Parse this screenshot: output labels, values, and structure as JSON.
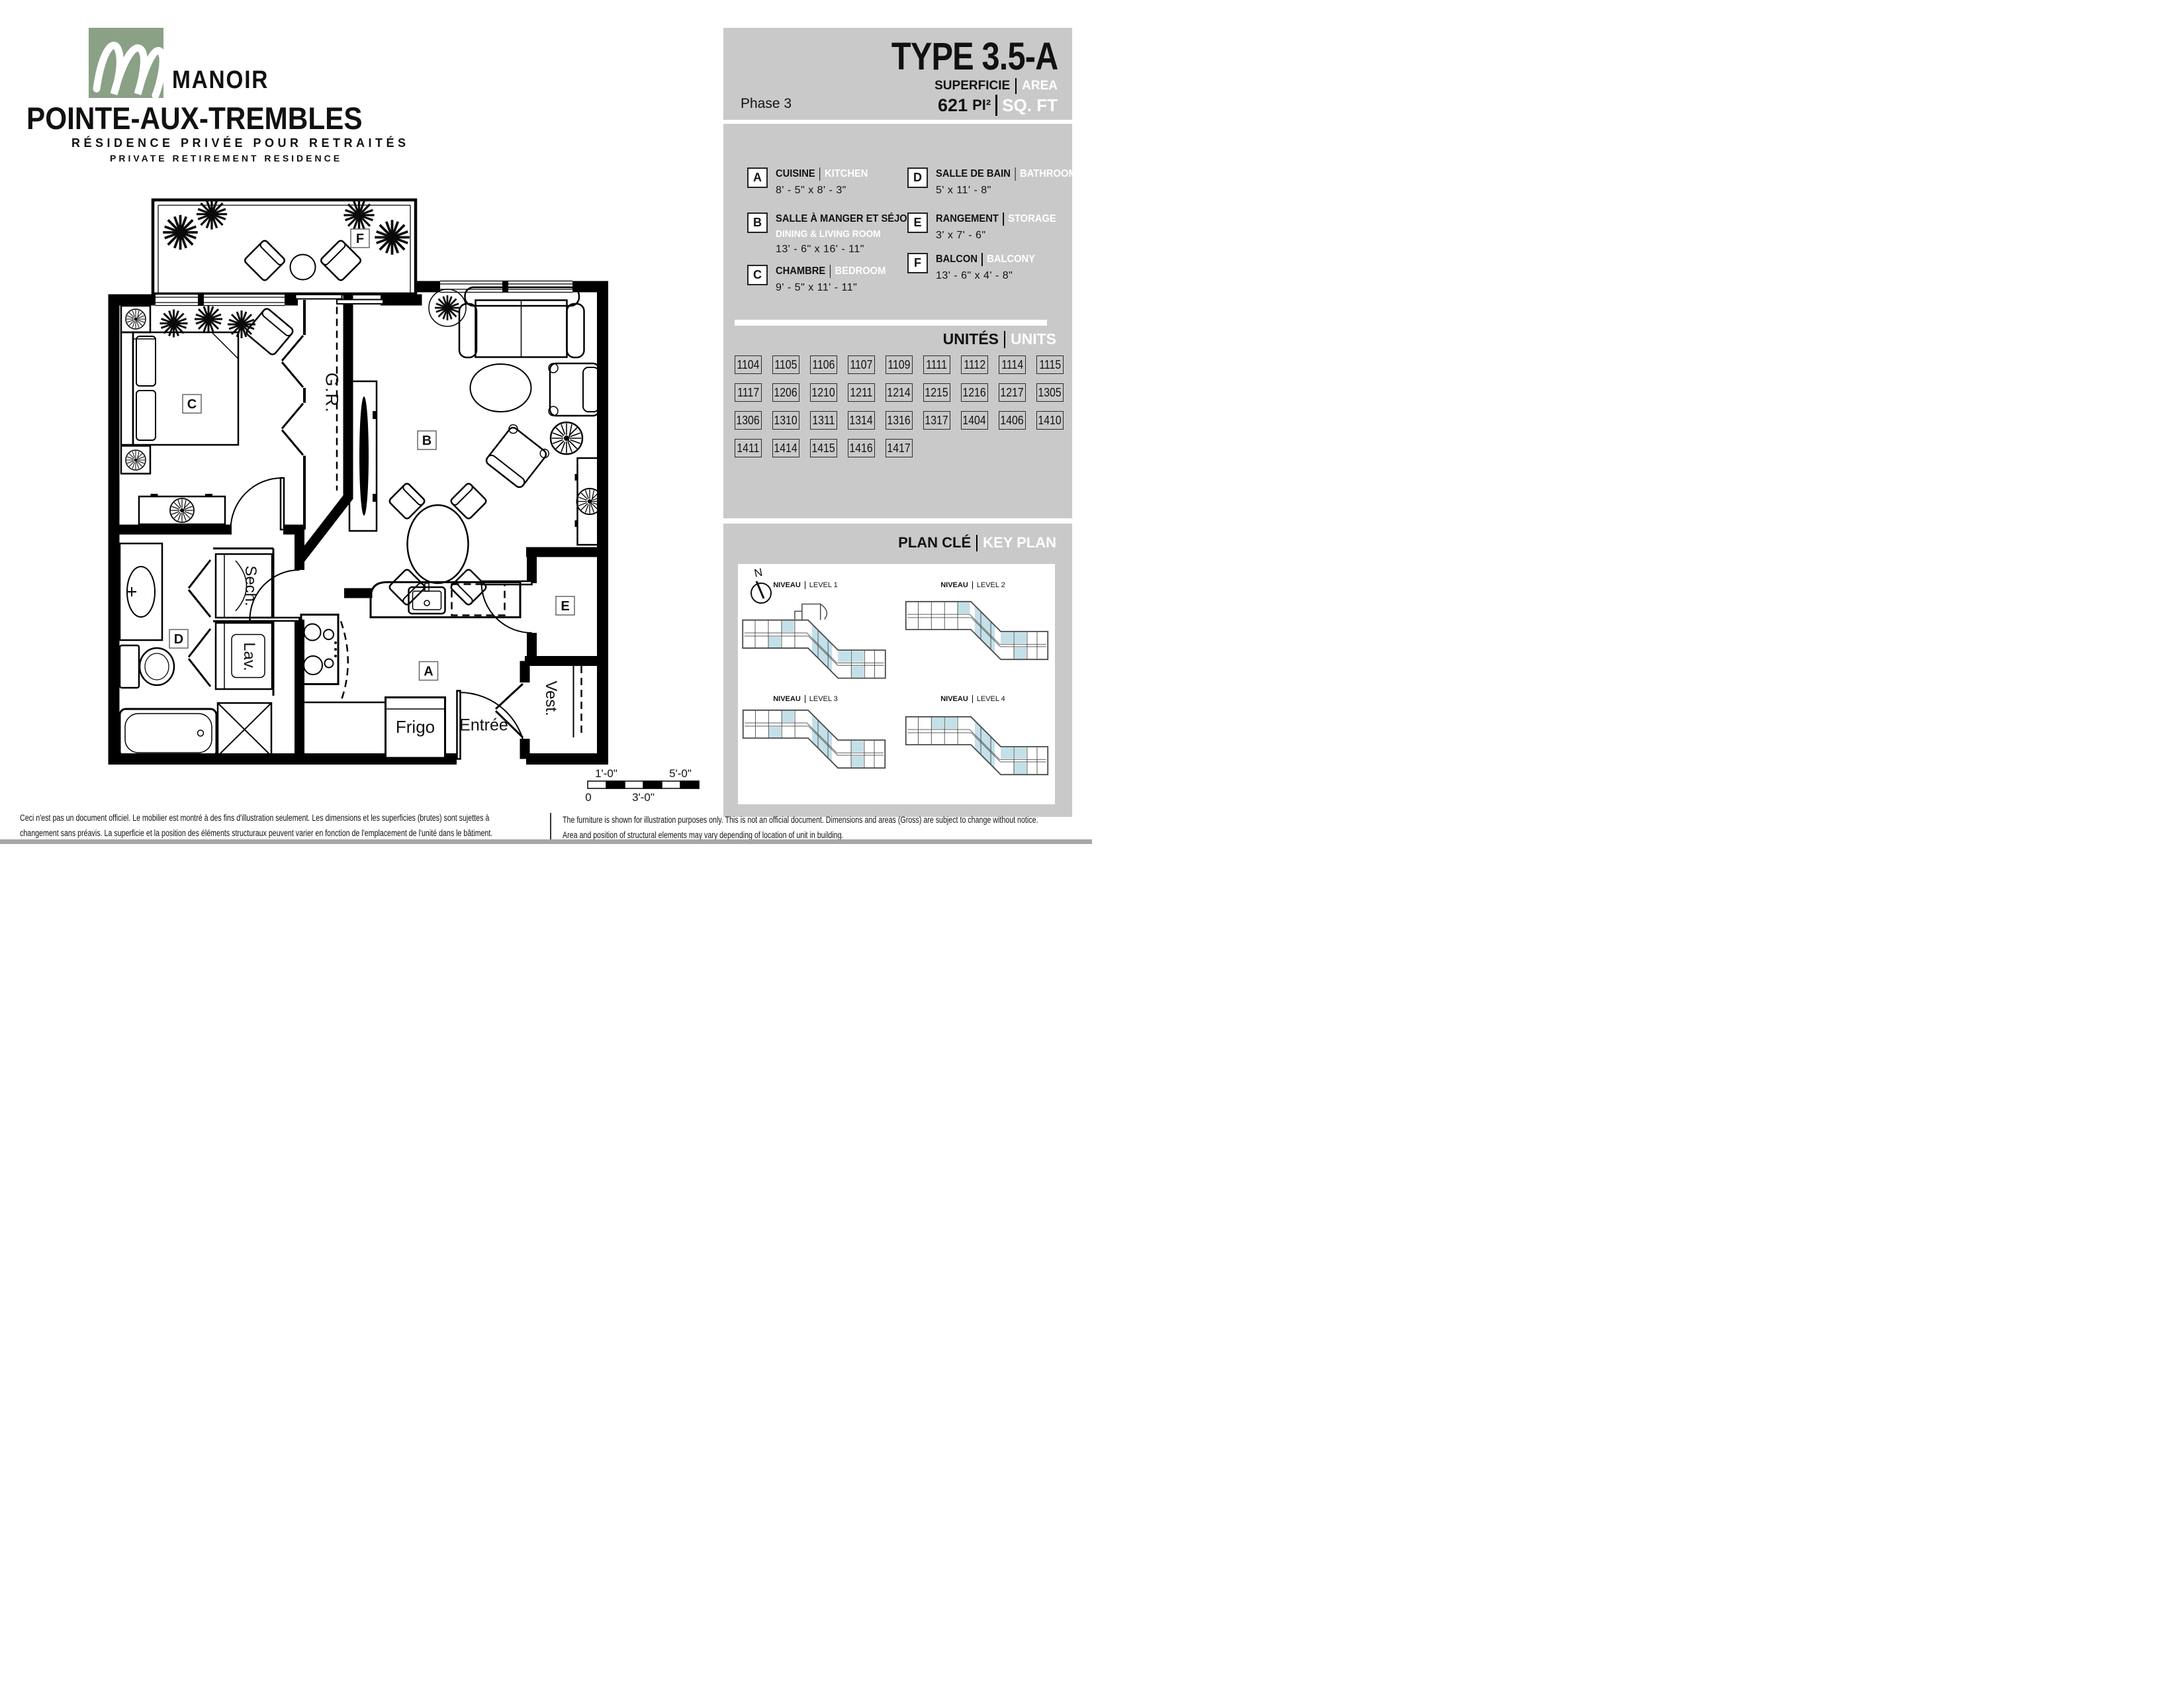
{
  "colors": {
    "panel_gray": "#c9c9c9",
    "logo_green": "#8aa186",
    "keyplan_highlight_blue": "#c3e0e9",
    "keyplan_outline": "#4a4a4a",
    "bottom_strip_gray": "#a6a6a6",
    "text_black": "#111111",
    "text_white": "#ffffff"
  },
  "logo": {
    "monogram": "M",
    "brand_line1": "MANOIR",
    "brand_line2": "POINTE-AUX-TREMBLES",
    "tagline_fr": "RÉSIDENCE PRIVÉE POUR RETRAITÉS",
    "tagline_en": "PRIVATE RETIREMENT RESIDENCE"
  },
  "header": {
    "type_title": "TYPE  3.5-A",
    "superficie_fr": "SUPERFICIE",
    "superficie_en": "AREA",
    "phase": "Phase 3",
    "area_value": "621",
    "area_unit_fr": "PI²",
    "area_unit_en": "SQ. FT"
  },
  "legend": {
    "items": [
      {
        "letter": "A",
        "fr": "CUISINE",
        "en": "KITCHEN",
        "en2": "",
        "dims": "8' - 5\" x 8' - 3\""
      },
      {
        "letter": "B",
        "fr": "SALLE À MANGER ET SÉJOUR",
        "en": "",
        "en2": "DINING & LIVING ROOM",
        "dims": "13' - 6\" x 16' - 11\""
      },
      {
        "letter": "C",
        "fr": "CHAMBRE",
        "en": "BEDROOM",
        "en2": "",
        "dims": "9' - 5\" x 11' - 11\""
      },
      {
        "letter": "D",
        "fr": "SALLE DE BAIN",
        "en": "BATHROOM",
        "en2": "",
        "dims": "5' x 11' - 8\""
      },
      {
        "letter": "E",
        "fr": "RANGEMENT",
        "en": "STORAGE",
        "en2": "",
        "dims": "3' x 7' - 6\""
      },
      {
        "letter": "F",
        "fr": "BALCON",
        "en": "BALCONY",
        "en2": "",
        "dims": "13' - 6\" x 4' - 8\""
      }
    ]
  },
  "units": {
    "title_fr": "UNITÉS",
    "title_en": "UNITS",
    "numbers": [
      "1104",
      "1105",
      "1106",
      "1107",
      "1109",
      "1111",
      "1112",
      "1114",
      "1115",
      "1117",
      "1206",
      "1210",
      "1211",
      "1214",
      "1215",
      "1216",
      "1217",
      "1305",
      "1306",
      "1310",
      "1311",
      "1314",
      "1316",
      "1317",
      "1404",
      "1406",
      "1410",
      "1411",
      "1414",
      "1415",
      "1416",
      "1417"
    ]
  },
  "keyplan": {
    "title_fr": "PLAN CLÉ",
    "title_en": "KEY PLAN",
    "north": "N",
    "levels": [
      {
        "fr": "NIVEAU",
        "en": "LEVEL 1"
      },
      {
        "fr": "NIVEAU",
        "en": "LEVEL 2"
      },
      {
        "fr": "NIVEAU",
        "en": "LEVEL 3"
      },
      {
        "fr": "NIVEAU",
        "en": "LEVEL 4"
      }
    ]
  },
  "plan": {
    "room_labels": {
      "a": "A",
      "b": "B",
      "c": "C",
      "d": "D",
      "e": "E",
      "f": "F"
    },
    "texts": {
      "gr": "G.R.",
      "sech": "Sech.",
      "lav": "Lav.",
      "frigo": "Frigo",
      "entree": "Entrée",
      "vest": "Vest."
    }
  },
  "scalebar": {
    "zero": "0",
    "one": "1'-0\"",
    "three": "3'-0\"",
    "five": "5'-0\""
  },
  "disclaimer": {
    "fr1": "Ceci n'est pas un document officiel.  Le mobilier est montré à des fins d'illustration seulement.  Les dimensions et les superficies (brutes) sont sujettes à",
    "fr2": "changement sans préavis. La superficie et la position des éléments structuraux peuvent varier en fonction de l'emplacement de l'unité dans le bâtiment.",
    "en1": "The furniture is shown for illustration purposes only.  This is not an official document.  Dimensions and areas (Gross) are subject to change without notice.",
    "en2": "Area and position of structural elements may vary depending of location of unit in building."
  }
}
